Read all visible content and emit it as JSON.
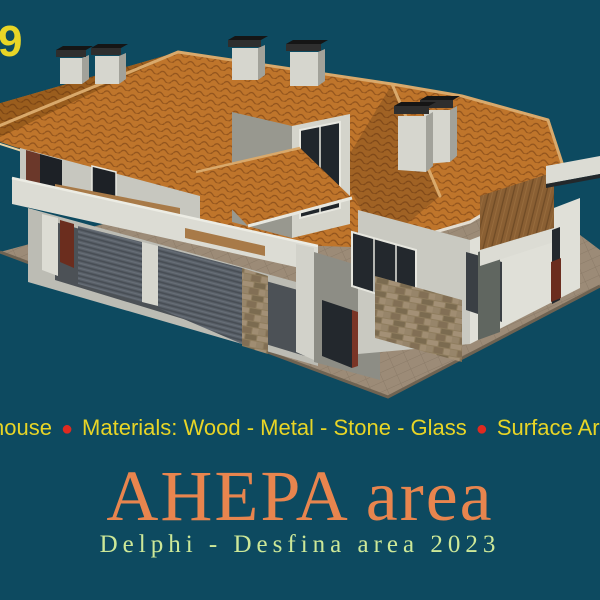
{
  "background_color": "#0d4a60",
  "corner_number": {
    "text": "9",
    "color": "#e8d526"
  },
  "banner": {
    "segments": [
      "house",
      "Materials: Wood - Metal - Stone - Glass",
      "Surface Area: 1"
    ],
    "bullet": "●",
    "text_color": "#e8d526",
    "bullet_color": "#e02a20"
  },
  "title": {
    "text": "AHEPA area",
    "color": "#e8854e"
  },
  "subtitle": {
    "text": "Delphi - Desfina area 2023",
    "color": "#cde898"
  },
  "scene": {
    "description": "3D rendering of a two-storey house with terracotta hip roof, garage roller doors, stone accents, wood balcony and paved terrace",
    "colors": {
      "roof": "#bf752b",
      "roof_shadow": "#9a5d1d",
      "ridge": "#d9a96b",
      "wall_light": "#e0e0d8",
      "wall_mid": "#c7c7bf",
      "wall_shadow": "#8d8d85",
      "garage_door": "#5a6169",
      "stone": "#8f7d5e",
      "wood": "#8a5f33",
      "pavement": "#9c8b77",
      "window_glass": "#20262b",
      "door_red": "#6b2d1e",
      "chimney_cap": "#151515"
    }
  }
}
